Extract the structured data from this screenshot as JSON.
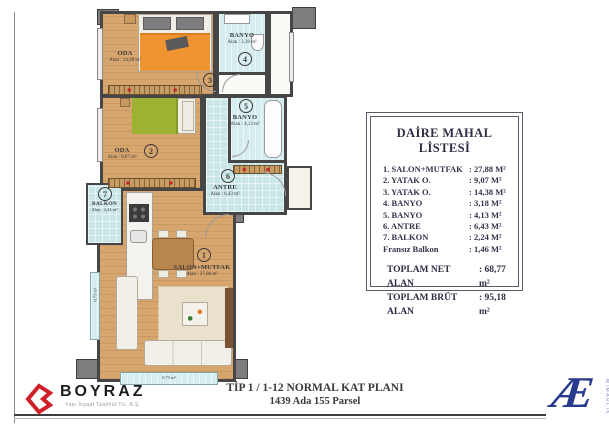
{
  "plan": {
    "rooms": [
      {
        "number": "1",
        "label": "SALON+MUTFAK",
        "area": "Alan : 27,88 m²"
      },
      {
        "number": "2",
        "label": "ODA",
        "area": "Alan : 9,07 m²"
      },
      {
        "number": "3",
        "label": "ODA",
        "area": "Alan : 14,38 m²"
      },
      {
        "number": "4",
        "label": "BANYO",
        "area": "Alan : 3,18 m²"
      },
      {
        "number": "5",
        "label": "BANYO",
        "area": "Alan : 4,13 m²"
      },
      {
        "number": "6",
        "label": "ANTRE",
        "area": "Alan : 6,43 m²"
      },
      {
        "number": "7",
        "label": "BALKON",
        "area": "Alan : 2,24 m²"
      }
    ],
    "french_balcony_left": "0,73 m²",
    "french_balcony_bottom": "0,73 m²"
  },
  "list": {
    "title": "DAİRE MAHAL LİSTESİ",
    "rows": [
      {
        "name": "1. SALON+MUTFAK",
        "value": ":  27,88 M²"
      },
      {
        "name": "2. YATAK O.",
        "value": ":  9,07 M²"
      },
      {
        "name": "3. YATAK O.",
        "value": ":  14,38 M²"
      },
      {
        "name": "4. BANYO",
        "value": ":  3,18 M²"
      },
      {
        "name": "5. BANYO",
        "value": ":  4,13 M²"
      },
      {
        "name": "6. ANTRE",
        "value": ":  6,43 M²"
      },
      {
        "name": "7. BALKON",
        "value": ":  2,24 M²"
      },
      {
        "name": "Fransız Balkon",
        "value": ":  1,46 M²"
      }
    ],
    "totals": [
      {
        "name": "TOPLAM NET ALAN",
        "value": ": 68,77 m²"
      },
      {
        "name": "TOPLAM BRÜT ALAN",
        "value": ": 95,18 m²"
      }
    ]
  },
  "footer": {
    "brand": "BOYRAZ",
    "brand_sub": "Yapı İnşaat Taahhüt Tic. A.Ş.",
    "plan_title": "TİP 1 / 1-12 NORMAL KAT PLANI",
    "plan_subtitle": "1439 Ada 155 Parsel",
    "architect_mark": "Æ",
    "architect_sub": "MİMARLIK"
  },
  "colors": {
    "wall": "#464646",
    "wood_floor": "#d7a56e",
    "wet_floor": "#c9e6e7",
    "brand_red": "#cf2027",
    "architect_navy": "#283a8e"
  }
}
